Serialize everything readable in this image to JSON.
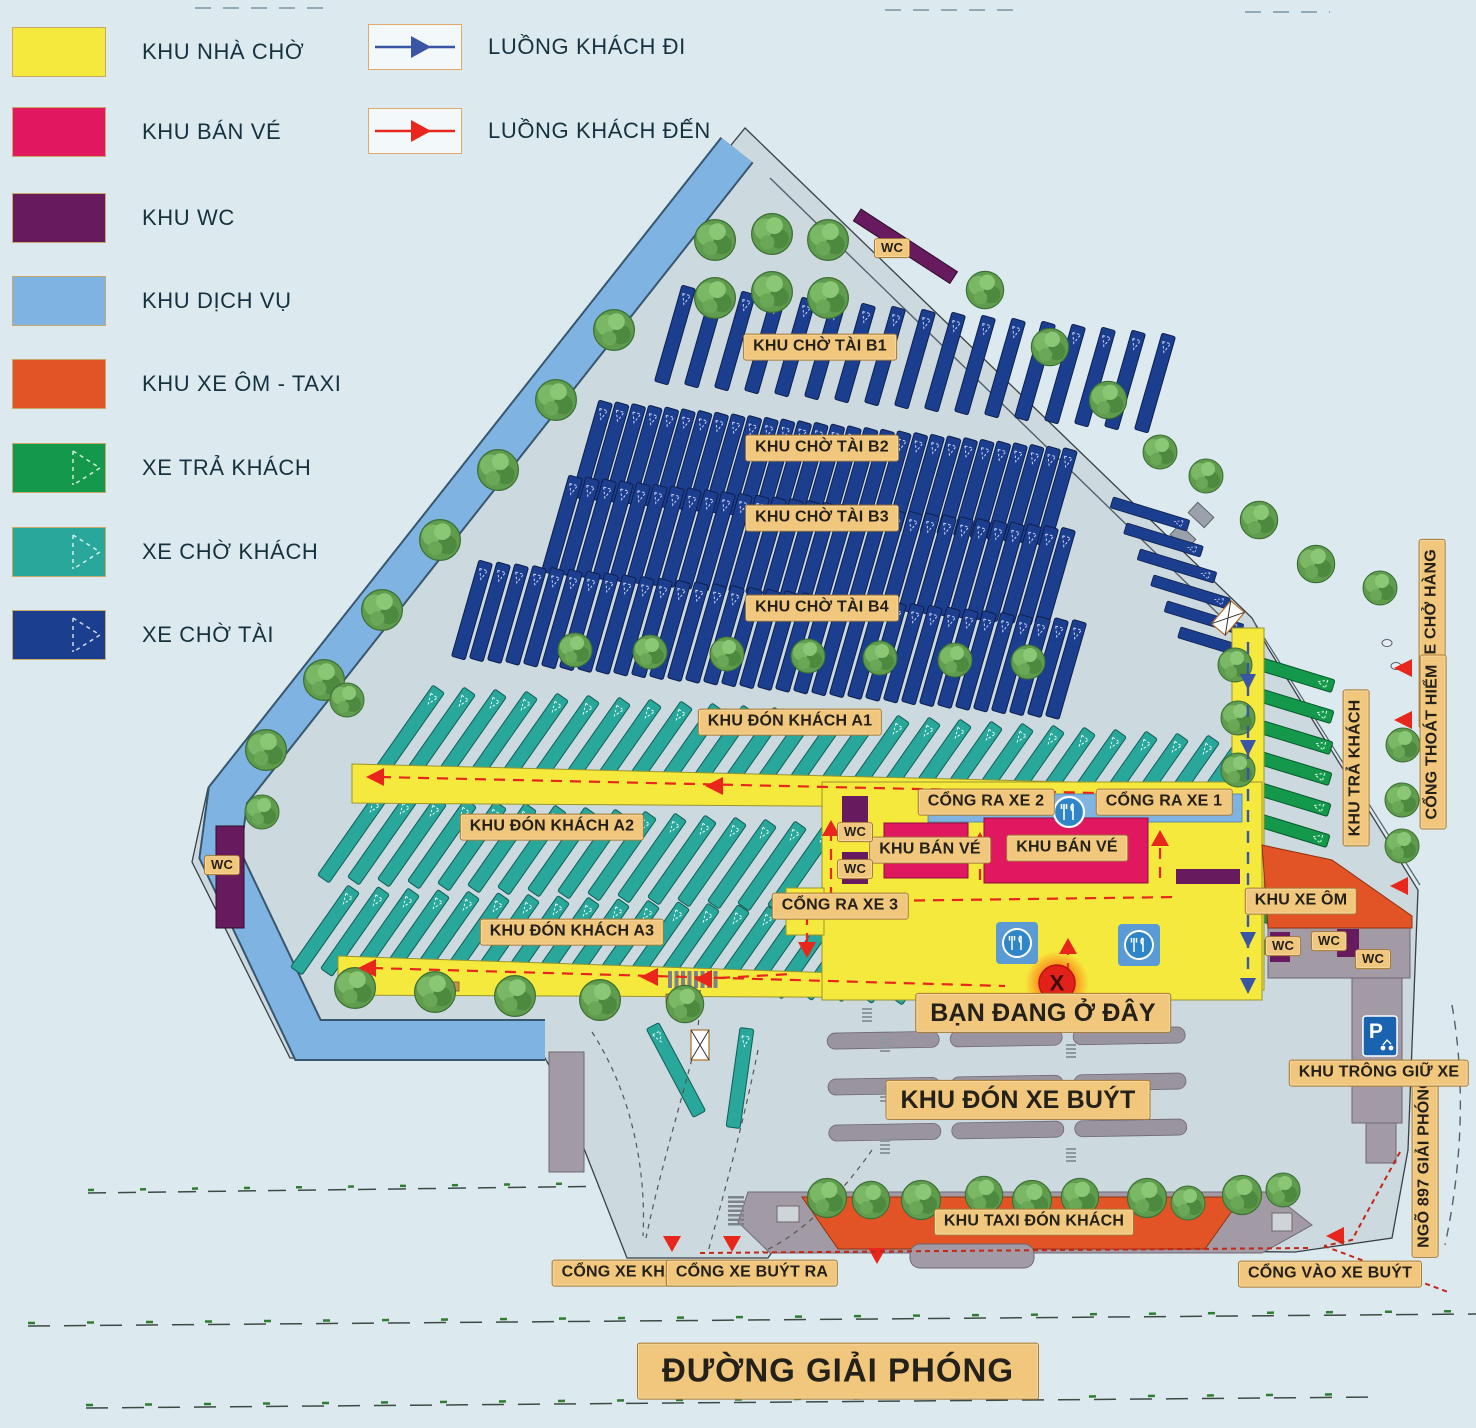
{
  "legend": {
    "areas": [
      {
        "label": "KHU NHÀ CHỜ",
        "color": "#F6E93D"
      },
      {
        "label": "KHU BÁN VÉ",
        "color": "#E0185F"
      },
      {
        "label": "KHU WC",
        "color": "#671B5E"
      },
      {
        "label": "KHU DỊCH VỤ",
        "color": "#7FB4E2"
      },
      {
        "label": "KHU XE ÔM - TAXI",
        "color": "#E25426"
      },
      {
        "label": "XE TRẢ KHÁCH",
        "color": "#14994C"
      },
      {
        "label": "XE CHỜ KHÁCH",
        "color": "#2AA79B"
      },
      {
        "label": "XE CHỜ TÀI",
        "color": "#1C3E8E"
      }
    ],
    "flows": [
      {
        "label": "LUỒNG KHÁCH ĐI",
        "color": "#3B55A5"
      },
      {
        "label": "LUỒNG KHÁCH ĐẾN",
        "color": "#E8261C"
      }
    ]
  },
  "map": {
    "zones": {
      "wc": "WC",
      "khu_cho_tai_b1": "KHU CHỜ TÀI B1",
      "khu_cho_tai_b2": "KHU CHỜ TÀI B2",
      "khu_cho_tai_b3": "KHU CHỜ TÀI B3",
      "khu_cho_tai_b4": "KHU CHỜ TÀI B4",
      "khu_don_khach_a1": "KHU ĐÓN KHÁCH A1",
      "khu_don_khach_a2": "KHU ĐÓN KHÁCH A2",
      "khu_don_khach_a3": "KHU ĐÓN KHÁCH A3",
      "khu_ban_ve": "KHU BÁN VÉ",
      "khu_tra_khach": "KHU TRẢ KHÁCH",
      "khu_xe_om": "KHU XE ÔM",
      "khu_don_xe_buyt": "KHU ĐÓN XE BUÝT",
      "khu_taxi_don_khach": "KHU TAXI ĐÓN KHÁCH",
      "khu_trong_giu_xe": "KHU TRÔNG GIỮ XE"
    },
    "gates": {
      "cong_ra_xe_1": "CỔNG RA XE 1",
      "cong_ra_xe_2": "CỔNG RA XE 2",
      "cong_ra_xe_3": "CỔNG RA XE 3",
      "cong_xe_cho_hang": "CỔNG XE CHỞ HÀNG",
      "cong_thoat_hiem": "CỔNG THOÁT HIỂM",
      "cong_xe_khach_ra": "CỔNG XE KHÁCH RA",
      "cong_xe_buyt_ra": "CỔNG XE BUÝT RA",
      "cong_vao_xe_buyt": "CỔNG VÀO XE BUÝT"
    },
    "streets": {
      "duong_giai_phong": "ĐƯỜNG GIẢI PHÓNG",
      "ngo_897_giai_phong": "NGÕ 897 GIẢI PHÓNG"
    },
    "you_are_here": {
      "label": "BẠN ĐANG Ở ĐÂY",
      "marker": "X"
    },
    "parking_sign": "P"
  }
}
